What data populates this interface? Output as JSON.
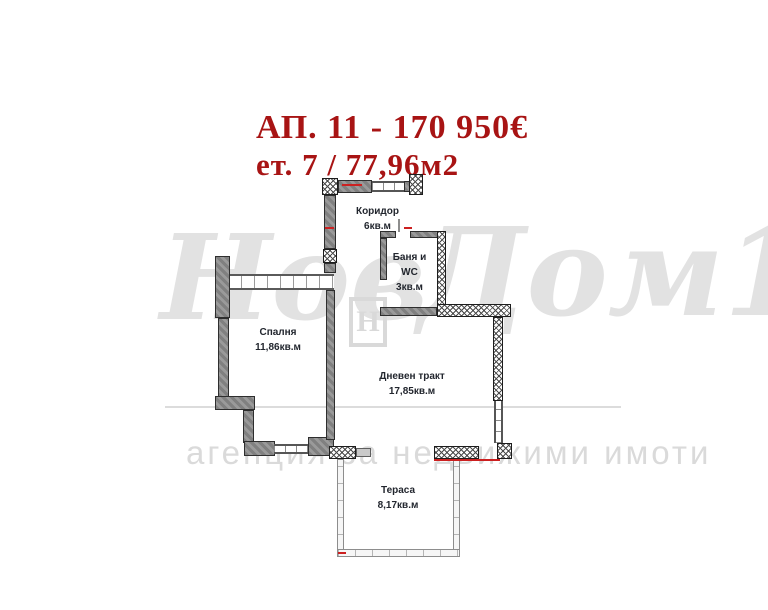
{
  "header": {
    "line1": "АП. 11 - 170 950€",
    "line2": "ет. 7  /  77,96м2"
  },
  "watermark": {
    "brand_part1": "Нов",
    "brand_part2": "Дом1",
    "logo_letter": "Н",
    "tagline": "агенция за недвижими имоти"
  },
  "plan": {
    "corridor": {
      "name": "Коридор",
      "area": "6кв.м"
    },
    "bathroom": {
      "name_line1": "Баня и",
      "name_line2": "WC",
      "area": "3кв.м"
    },
    "bedroom": {
      "name": "Спалня",
      "area": "11,86кв.м"
    },
    "living_room": {
      "name": "Дневен тракт",
      "area": "17,85кв.м"
    },
    "terrace": {
      "name": "Тераса",
      "area": "8,17кв.м"
    }
  },
  "colors": {
    "title_red": "#a81414",
    "wall_gray": "#8a8a8a",
    "dimension_red": "#cc2020",
    "watermark_gray": "#dadada"
  }
}
